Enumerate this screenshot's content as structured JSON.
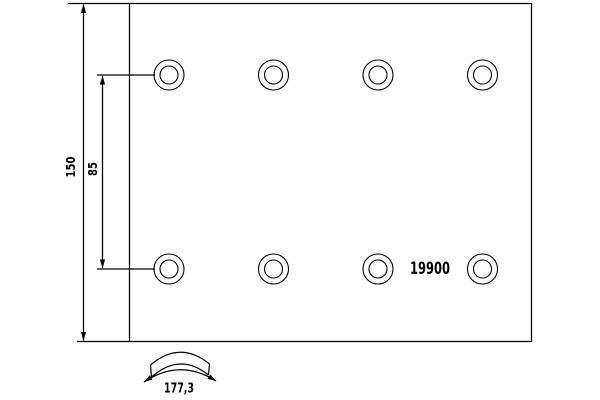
{
  "drawing": {
    "type": "brake-lining-technical-drawing",
    "part_number": "19900",
    "dimensions": {
      "total_height": "150",
      "rivet_row_spacing": "85",
      "arc_width": "177,3"
    },
    "holes": {
      "count": 8,
      "rows": 2,
      "columns": 4
    },
    "colors": {
      "line": "#000000",
      "background": "#ffffff"
    }
  }
}
